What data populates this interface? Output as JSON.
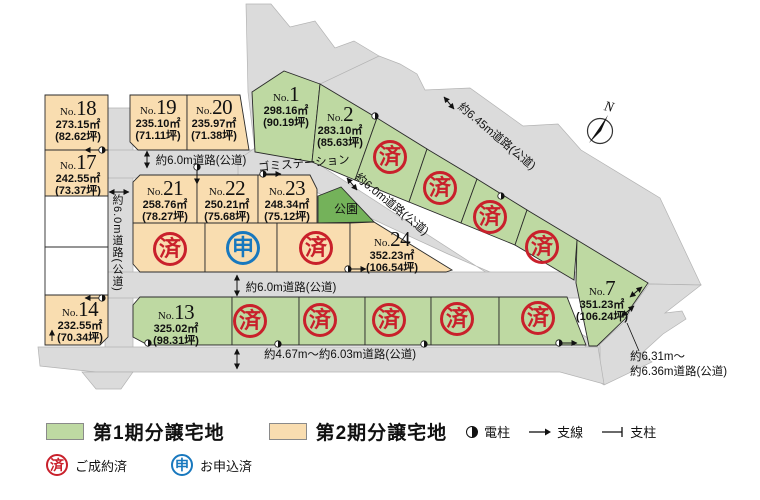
{
  "colors": {
    "phase1_green": "#bed9a2",
    "phase2_orange": "#f9ddb0",
    "park_green": "#74b25a",
    "white_lot": "#ffffff",
    "road_gray": "#dbdbdb",
    "sold_red": "#c9202b",
    "applied_blue": "#1878be"
  },
  "map": {
    "north": "N",
    "park": "公園",
    "garbage_station": "ゴミステーション",
    "roads": {
      "top": "約6.0m道路(公道)",
      "left_vertical": "約6.0m道路(公道)",
      "middle": "約6.0m道路(公道)",
      "bottom": "約4.67m～約6.03m道路(公道)",
      "diag_645": "約6.45m道路(公道)",
      "diag_60": "約6.0m道路(公道)",
      "right_line1": "約6.31m～",
      "right_line2": "約6.36m道路(公道)"
    },
    "lots": {
      "no1": {
        "prefix": "No.",
        "num": "1",
        "area": "298.16㎡",
        "tsubo": "(90.19坪)"
      },
      "no2": {
        "prefix": "No.",
        "num": "2",
        "area": "283.10㎡",
        "tsubo": "(85.63坪)"
      },
      "no7": {
        "prefix": "No.",
        "num": "7",
        "area": "351.23㎡",
        "tsubo": "(106.24坪)"
      },
      "no13": {
        "prefix": "No.",
        "num": "13",
        "area": "325.02㎡",
        "tsubo": "(98.31坪)"
      },
      "no14": {
        "prefix": "No.",
        "num": "14",
        "area": "232.55㎡",
        "tsubo": "(70.34坪)"
      },
      "no17": {
        "prefix": "No.",
        "num": "17",
        "area": "242.55㎡",
        "tsubo": "(73.37坪)"
      },
      "no18": {
        "prefix": "No.",
        "num": "18",
        "area": "273.15㎡",
        "tsubo": "(82.62坪)"
      },
      "no19": {
        "prefix": "No.",
        "num": "19",
        "area": "235.10㎡",
        "tsubo": "(71.11坪)"
      },
      "no20": {
        "prefix": "No.",
        "num": "20",
        "area": "235.97㎡",
        "tsubo": "(71.38坪)"
      },
      "no21": {
        "prefix": "No.",
        "num": "21",
        "area": "258.76㎡",
        "tsubo": "(78.27坪)"
      },
      "no22": {
        "prefix": "No.",
        "num": "22",
        "area": "250.21㎡",
        "tsubo": "(75.68坪)"
      },
      "no23": {
        "prefix": "No.",
        "num": "23",
        "area": "248.34㎡",
        "tsubo": "(75.12坪)"
      },
      "no24": {
        "prefix": "No.",
        "num": "24",
        "area": "352.23㎡",
        "tsubo": "(106.54坪)"
      }
    }
  },
  "legend": {
    "phase1": "第1期分譲宅地",
    "phase2": "第2期分譲宅地",
    "pole": "電柱",
    "wire": "支線",
    "post": "支柱",
    "sold_stamp": "済",
    "sold_label": "ご成約済",
    "applied_stamp": "申",
    "applied_label": "お申込済"
  }
}
